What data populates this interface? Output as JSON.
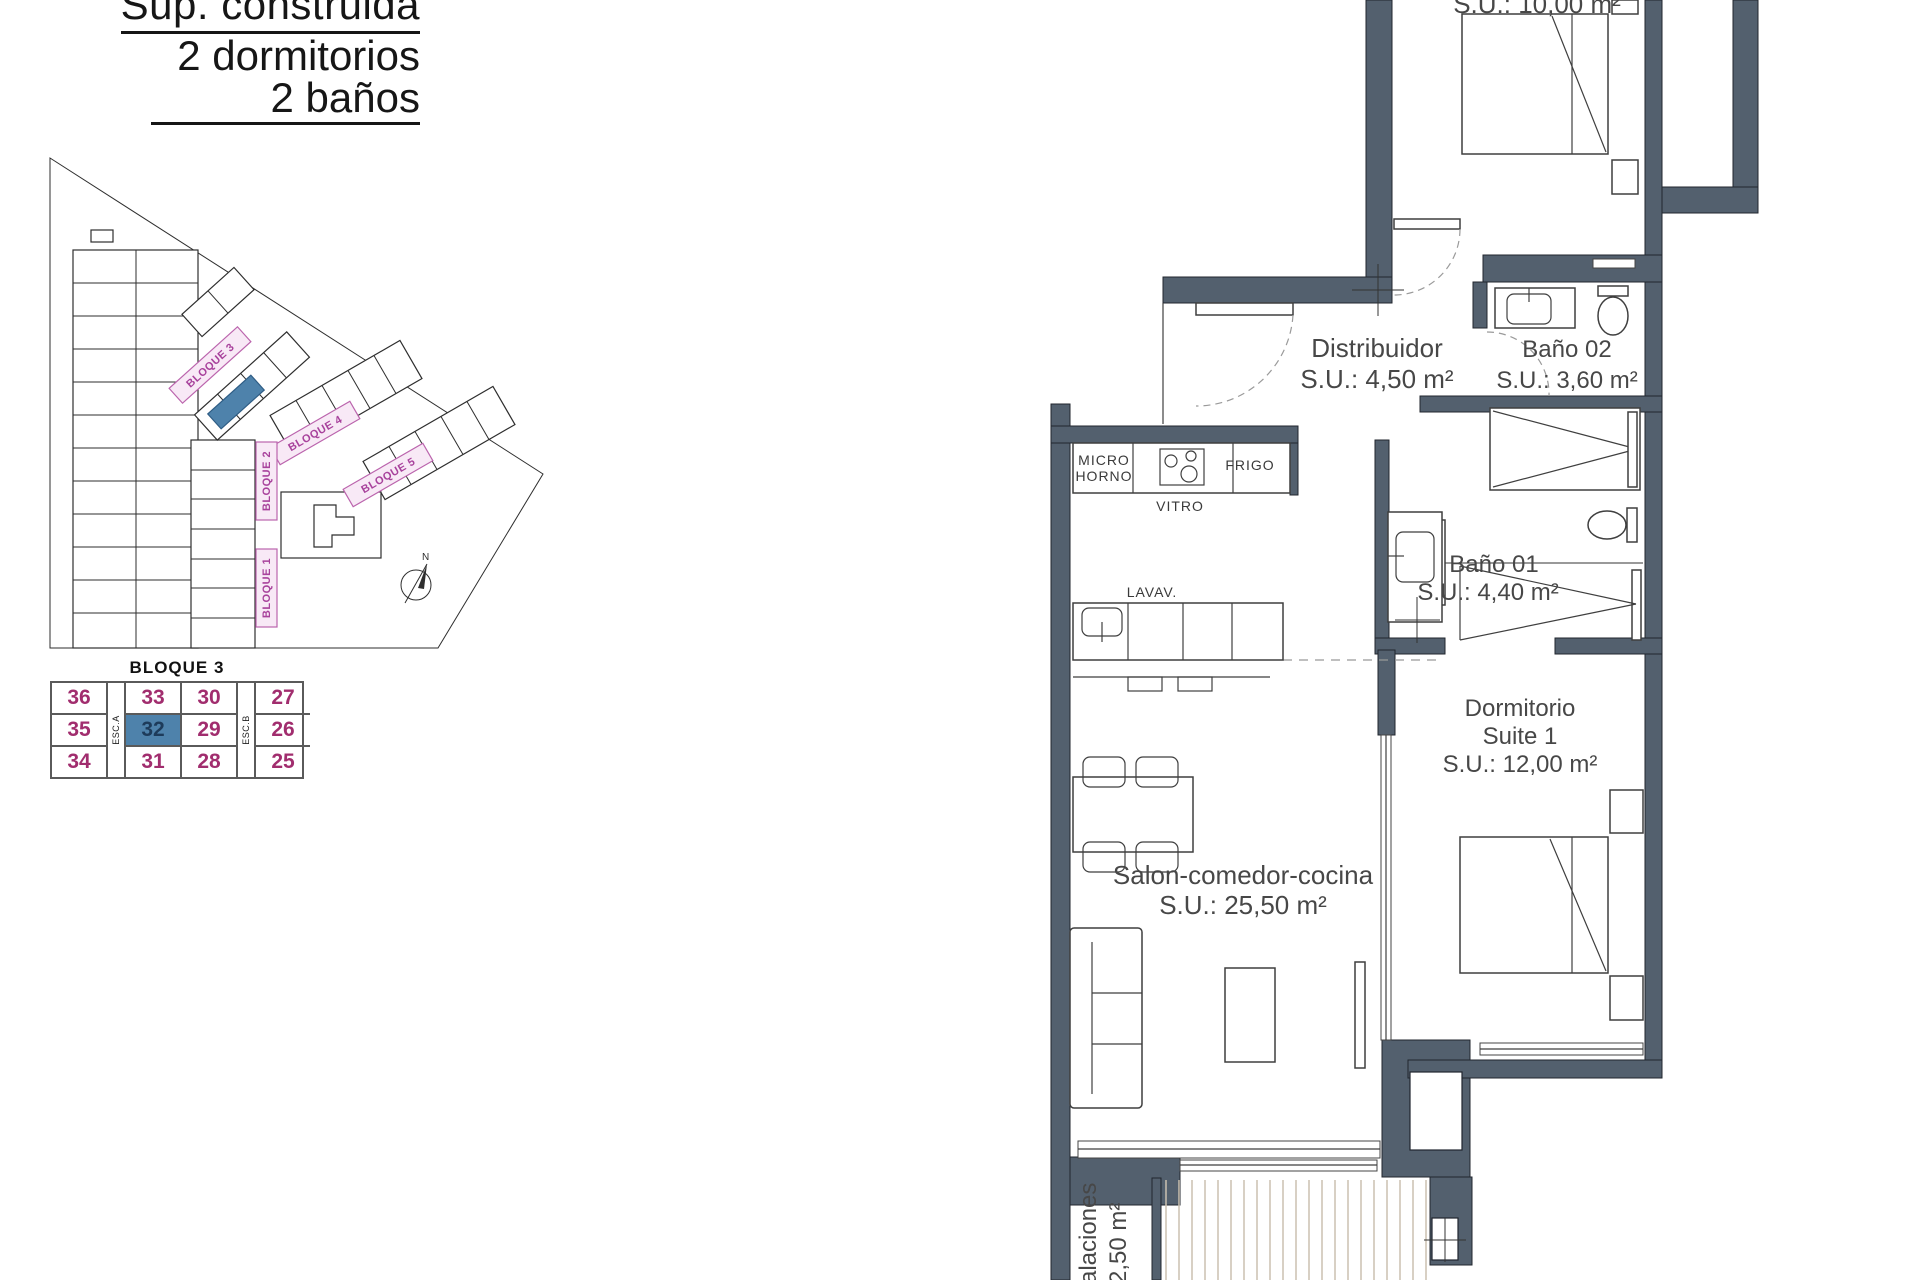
{
  "header": {
    "line1": "Sup. construida",
    "line2": "2 dormitorios",
    "line3": "2 baños"
  },
  "site": {
    "b1": "BLOQUE 1",
    "b2": "BLOQUE 2",
    "b3": "BLOQUE 3",
    "b4": "BLOQUE 4",
    "b5": "BLOQUE 5",
    "north": "N",
    "highlight_color": "#4e82ab",
    "label_color": "#a8429c"
  },
  "table": {
    "title": "BLOQUE 3",
    "esc_a": "ESC.A",
    "esc_b": "ESC.B",
    "highlighted_unit": "32",
    "number_color": "#a12d6e",
    "highlight_color": "#4e82ab",
    "rows": [
      [
        "36",
        "33",
        "30",
        "27"
      ],
      [
        "35",
        "32",
        "29",
        "26"
      ],
      [
        "34",
        "31",
        "28",
        "25"
      ]
    ]
  },
  "plan": {
    "wall_color": "#53606e",
    "bedroom2_su": "S.U.: 10,00 m²",
    "distribuidor": {
      "name": "Distribuidor",
      "su": "S.U.: 4,50 m²"
    },
    "bano02": {
      "name": "Baño 02",
      "su": "S.U.: 3,60 m²"
    },
    "bano01": {
      "name": "Baño 01",
      "su": "S.U.: 4,40 m²"
    },
    "suite": {
      "l1": "Dormitorio",
      "l2": "Suite 1",
      "l3": "S.U.: 12,00 m²"
    },
    "salon": {
      "l1": "Salon-comedor-cocina",
      "l2": "S.U.: 25,50 m²"
    },
    "inst": {
      "l1": "alaciones",
      "l2": "2,50 m²"
    },
    "kitchen": {
      "micro1": "MICRO",
      "micro2": "HORNO",
      "vitro": "VITRO",
      "frigo": "FRIGO",
      "lavav": "LAVAV."
    }
  }
}
